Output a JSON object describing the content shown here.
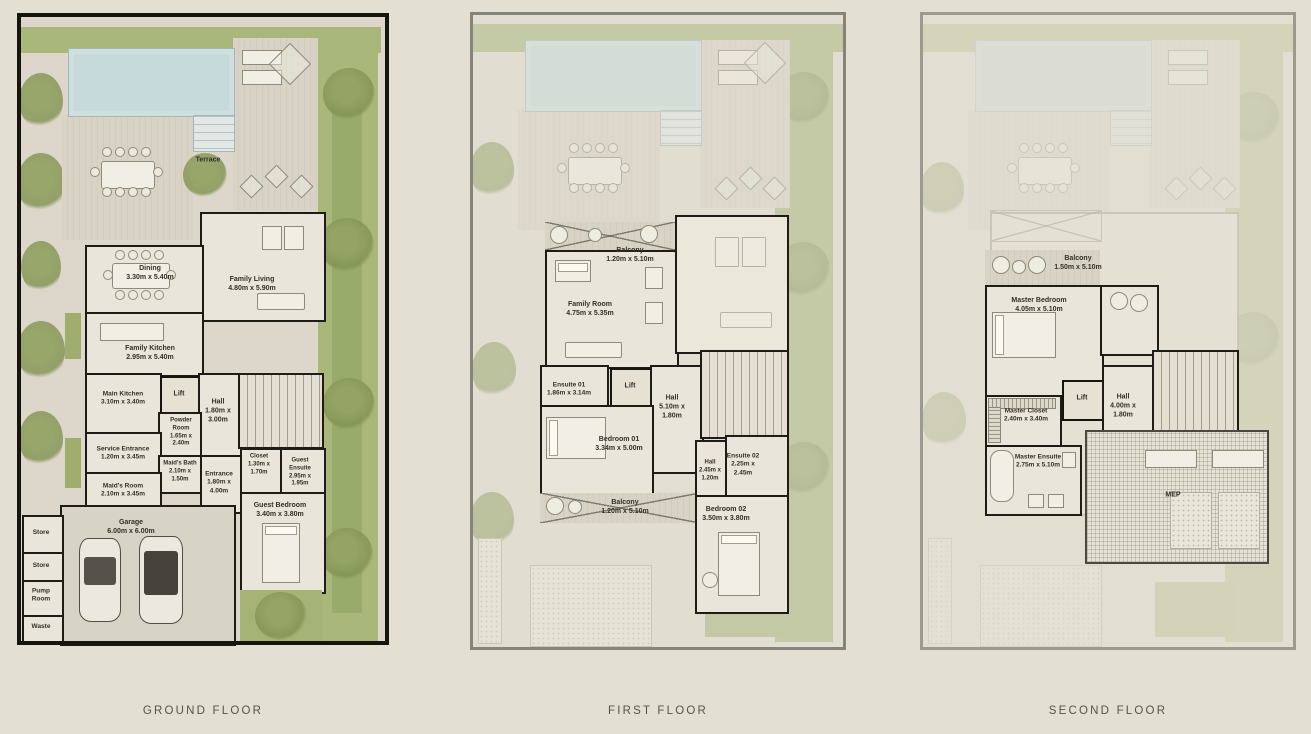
{
  "captions": {
    "ground": "GROUND FLOOR",
    "first": "FIRST FLOOR",
    "second": "SECOND FLOOR"
  },
  "ground": {
    "terrace": {
      "name": "Terrace"
    },
    "dining": {
      "name": "Dining",
      "dims": "3.30m x 5.40m"
    },
    "family_living": {
      "name": "Family Living",
      "dims": "4.80m x 5.90m"
    },
    "family_kitchen": {
      "name": "Family Kitchen",
      "dims": "2.95m x 5.40m"
    },
    "main_kitchen": {
      "name": "Main Kitchen",
      "dims": "3.10m x 3.40m"
    },
    "lift": {
      "name": "Lift"
    },
    "hall": {
      "name": "Hall",
      "dims": "1.80m x 3.00m"
    },
    "powder_room": {
      "name": "Powder Room",
      "dims": "1.65m x 2.40m"
    },
    "service_entrance": {
      "name": "Service Entrance",
      "dims": "1.20m x 3.45m"
    },
    "maids_bath": {
      "name": "Maid's Bath",
      "dims": "2.10m x 1.50m"
    },
    "maids_room": {
      "name": "Maid's Room",
      "dims": "2.10m x 3.45m"
    },
    "entrance": {
      "name": "Entrance",
      "dims": "1.80m x 4.00m"
    },
    "closet": {
      "name": "Closet",
      "dims": "1.30m x 1.70m"
    },
    "guest_ensuite": {
      "name": "Guest Ensuite",
      "dims": "2.95m x 1.95m"
    },
    "guest_bedroom": {
      "name": "Guest Bedroom",
      "dims": "3.40m x 3.80m"
    },
    "garage": {
      "name": "Garage",
      "dims": "6.00m x 6.00m"
    },
    "store1": {
      "name": "Store"
    },
    "store2": {
      "name": "Store"
    },
    "pump_room": {
      "name": "Pump Room"
    },
    "waste": {
      "name": "Waste"
    }
  },
  "first": {
    "balcony_top": {
      "name": "Balcony",
      "dims": "1.20m x 5.10m"
    },
    "family_room": {
      "name": "Family Room",
      "dims": "4.75m x 5.35m"
    },
    "ensuite_01": {
      "name": "Ensuite 01",
      "dims": "1.86m x 3.14m"
    },
    "lift": {
      "name": "Lift"
    },
    "hall": {
      "name": "Hall",
      "dims": "5.10m x 1.80m"
    },
    "bedroom_01": {
      "name": "Bedroom 01",
      "dims": "3.34m x 5.00m"
    },
    "hall2": {
      "name": "Hall",
      "dims": "2.45m x 1.20m"
    },
    "ensuite_02": {
      "name": "Ensuite 02",
      "dims": "2.25m x 2.45m"
    },
    "balcony_bottom": {
      "name": "Balcony",
      "dims": "1.20m x 5.10m"
    },
    "bedroom_02": {
      "name": "Bedroom 02",
      "dims": "3.50m x 3.80m"
    }
  },
  "second": {
    "balcony": {
      "name": "Balcony",
      "dims": "1.50m x 5.10m"
    },
    "master_bedroom": {
      "name": "Master Bedroom",
      "dims": "4.05m x 5.10m"
    },
    "master_closet": {
      "name": "Master Closet",
      "dims": "2.40m x 3.40m"
    },
    "lift": {
      "name": "Lift"
    },
    "hall": {
      "name": "Hall",
      "dims": "4.00m x 1.80m"
    },
    "master_ensuite": {
      "name": "Master Ensuite",
      "dims": "2.75m x 5.10m"
    },
    "mep": {
      "name": "MEP"
    }
  },
  "colors": {
    "background": "#e3dfd3",
    "wall": "#16150f",
    "pool": "#c7dadb",
    "garden": "#a9b77b",
    "deck": "#d8d3c5",
    "room_floor": "#eae5da",
    "caption_text": "#55534b"
  }
}
